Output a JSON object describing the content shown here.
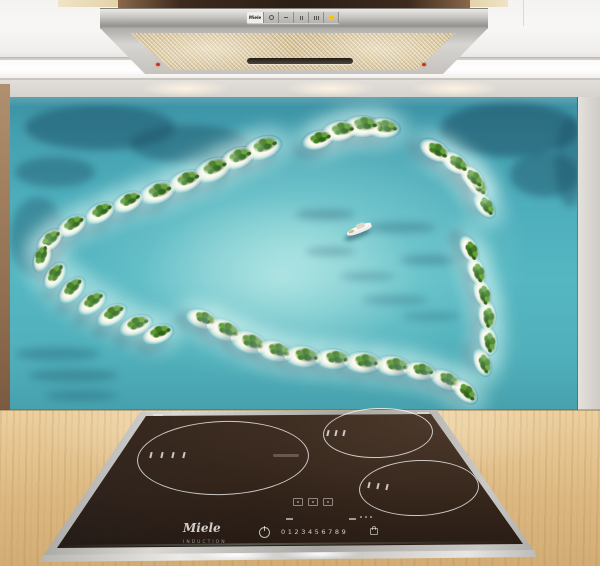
{
  "hood": {
    "brand": "Miele",
    "controls": {
      "buttons": [
        {
          "type": "power",
          "name": "power-button"
        },
        {
          "type": "fan-low",
          "name": "fan-low-button"
        },
        {
          "type": "fan-mid",
          "name": "fan-mid-button"
        },
        {
          "type": "fan-high",
          "name": "fan-high-button"
        },
        {
          "type": "light",
          "name": "light-button"
        }
      ],
      "light_indicator_color": "#f2c411"
    },
    "lamp_dot_color": "#c23318",
    "steel_color": "#c6c4c0",
    "filter_color": "#d4bf92"
  },
  "cooktop": {
    "brand": "Miele",
    "subbrand": "INDUCTION",
    "digits": [
      "0",
      "1",
      "2",
      "3",
      "4",
      "5",
      "6",
      "7",
      "8",
      "9"
    ],
    "glass_color": "#1f1510",
    "frame_color": "#cbc9c5",
    "zones": [
      {
        "name": "left-oval-zone",
        "cx": 222,
        "cy": 52,
        "rx": 85,
        "ry": 36,
        "ticks": [
          [
            150,
            47
          ],
          [
            161,
            47
          ],
          [
            172,
            47
          ],
          [
            183,
            47
          ]
        ]
      },
      {
        "name": "right-top-zone",
        "cx": 377,
        "cy": 27,
        "rx": 54,
        "ry": 24,
        "ticks": [
          [
            327,
            25
          ],
          [
            335,
            25
          ],
          [
            343,
            25
          ]
        ]
      },
      {
        "name": "right-bottom-zone",
        "cx": 418,
        "cy": 82,
        "rx": 59,
        "ry": 27,
        "ticks": [
          [
            368,
            77
          ],
          [
            377,
            78
          ],
          [
            386,
            79
          ]
        ]
      }
    ]
  },
  "splashback": {
    "subject": "heart-shaped tropical islands aerial view",
    "colors": {
      "ocean_deep": "#3a90a3",
      "lagoon": "#aee8e4",
      "sand": "#fdfaee",
      "palm_green": "#3f7d20",
      "reef_dark": "#1c4d64"
    },
    "boat": {
      "x": 336,
      "y": 127,
      "rotation": -22,
      "hull_color": "#ffffff"
    },
    "wall_glow_centers_x": [
      185,
      330,
      455
    ],
    "islands": [
      {
        "x": 252,
        "y": 51,
        "s": 1.2,
        "r": -18
      },
      {
        "x": 228,
        "y": 61,
        "s": 1.1,
        "r": -20
      },
      {
        "x": 202,
        "y": 73,
        "s": 1.2,
        "r": -22
      },
      {
        "x": 176,
        "y": 84,
        "s": 1.1,
        "r": -20
      },
      {
        "x": 148,
        "y": 95,
        "s": 1.15,
        "r": -18
      },
      {
        "x": 118,
        "y": 105,
        "s": 1.0,
        "r": -25
      },
      {
        "x": 90,
        "y": 116,
        "s": 1.0,
        "r": -28
      },
      {
        "x": 62,
        "y": 129,
        "s": 1.0,
        "r": -30
      },
      {
        "x": 40,
        "y": 143,
        "s": 0.95,
        "r": -40
      },
      {
        "x": 32,
        "y": 161,
        "s": 0.9,
        "r": -70
      },
      {
        "x": 45,
        "y": 178,
        "s": 0.95,
        "r": -55
      },
      {
        "x": 62,
        "y": 193,
        "s": 1.0,
        "r": -45
      },
      {
        "x": 82,
        "y": 206,
        "s": 1.0,
        "r": -35
      },
      {
        "x": 102,
        "y": 218,
        "s": 1.0,
        "r": -30
      },
      {
        "x": 126,
        "y": 228,
        "s": 1.05,
        "r": -20
      },
      {
        "x": 148,
        "y": 237,
        "s": 1.0,
        "r": -18
      },
      {
        "x": 192,
        "y": 222,
        "s": 1.0,
        "r": 20
      },
      {
        "x": 215,
        "y": 233,
        "s": 1.1,
        "r": 22
      },
      {
        "x": 240,
        "y": 245,
        "s": 1.15,
        "r": 20
      },
      {
        "x": 266,
        "y": 254,
        "s": 1.1,
        "r": 15
      },
      {
        "x": 294,
        "y": 259,
        "s": 1.15,
        "r": 8
      },
      {
        "x": 324,
        "y": 262,
        "s": 1.1,
        "r": 5
      },
      {
        "x": 354,
        "y": 265,
        "s": 1.15,
        "r": 5
      },
      {
        "x": 384,
        "y": 269,
        "s": 1.1,
        "r": 8
      },
      {
        "x": 410,
        "y": 274,
        "s": 1.0,
        "r": 10
      },
      {
        "x": 436,
        "y": 283,
        "s": 1.0,
        "r": 25
      },
      {
        "x": 455,
        "y": 294,
        "s": 0.95,
        "r": 45
      },
      {
        "x": 472,
        "y": 265,
        "s": 0.9,
        "r": 70
      },
      {
        "x": 478,
        "y": 243,
        "s": 0.95,
        "r": 80
      },
      {
        "x": 477,
        "y": 218,
        "s": 0.95,
        "r": 85
      },
      {
        "x": 472,
        "y": 196,
        "s": 0.9,
        "r": 75
      },
      {
        "x": 466,
        "y": 174,
        "s": 0.9,
        "r": 70
      },
      {
        "x": 459,
        "y": 152,
        "s": 0.9,
        "r": 65
      },
      {
        "x": 474,
        "y": 108,
        "s": 0.9,
        "r": 55
      },
      {
        "x": 466,
        "y": 88,
        "s": 0.9,
        "r": 50
      },
      {
        "x": 462,
        "y": 80,
        "s": 0.95,
        "r": 45
      },
      {
        "x": 445,
        "y": 66,
        "s": 1.0,
        "r": 35
      },
      {
        "x": 425,
        "y": 53,
        "s": 1.05,
        "r": 30
      },
      {
        "x": 373,
        "y": 31,
        "s": 1.1,
        "r": 5
      },
      {
        "x": 352,
        "y": 29,
        "s": 1.15,
        "r": 0
      },
      {
        "x": 330,
        "y": 34,
        "s": 1.1,
        "r": -8
      },
      {
        "x": 308,
        "y": 43,
        "s": 1.0,
        "r": -15
      }
    ],
    "reefs": [
      {
        "x": 15,
        "y": 8,
        "w": 150,
        "h": 45,
        "o": 0.5
      },
      {
        "x": 120,
        "y": 28,
        "w": 120,
        "h": 38,
        "o": 0.45
      },
      {
        "x": 5,
        "y": 60,
        "w": 80,
        "h": 30,
        "o": 0.4
      },
      {
        "x": 0,
        "y": 100,
        "w": 55,
        "h": 80,
        "o": 0.35
      },
      {
        "x": 430,
        "y": 5,
        "w": 140,
        "h": 55,
        "o": 0.55
      },
      {
        "x": 500,
        "y": 55,
        "w": 70,
        "h": 45,
        "o": 0.45
      },
      {
        "x": 545,
        "y": 20,
        "w": 30,
        "h": 90,
        "o": 0.4
      },
      {
        "x": 285,
        "y": 112,
        "w": 60,
        "h": 11,
        "o": 0.3
      },
      {
        "x": 355,
        "y": 125,
        "w": 70,
        "h": 11,
        "o": 0.3
      },
      {
        "x": 295,
        "y": 150,
        "w": 50,
        "h": 9,
        "o": 0.28
      },
      {
        "x": 390,
        "y": 158,
        "w": 58,
        "h": 10,
        "o": 0.3
      },
      {
        "x": 330,
        "y": 175,
        "w": 55,
        "h": 9,
        "o": 0.25
      },
      {
        "x": 5,
        "y": 250,
        "w": 85,
        "h": 14,
        "o": 0.3
      },
      {
        "x": 18,
        "y": 272,
        "w": 90,
        "h": 13,
        "o": 0.3
      },
      {
        "x": 35,
        "y": 293,
        "w": 72,
        "h": 11,
        "o": 0.28
      },
      {
        "x": 352,
        "y": 198,
        "w": 66,
        "h": 10,
        "o": 0.25
      },
      {
        "x": 392,
        "y": 215,
        "w": 58,
        "h": 9,
        "o": 0.25
      }
    ]
  }
}
